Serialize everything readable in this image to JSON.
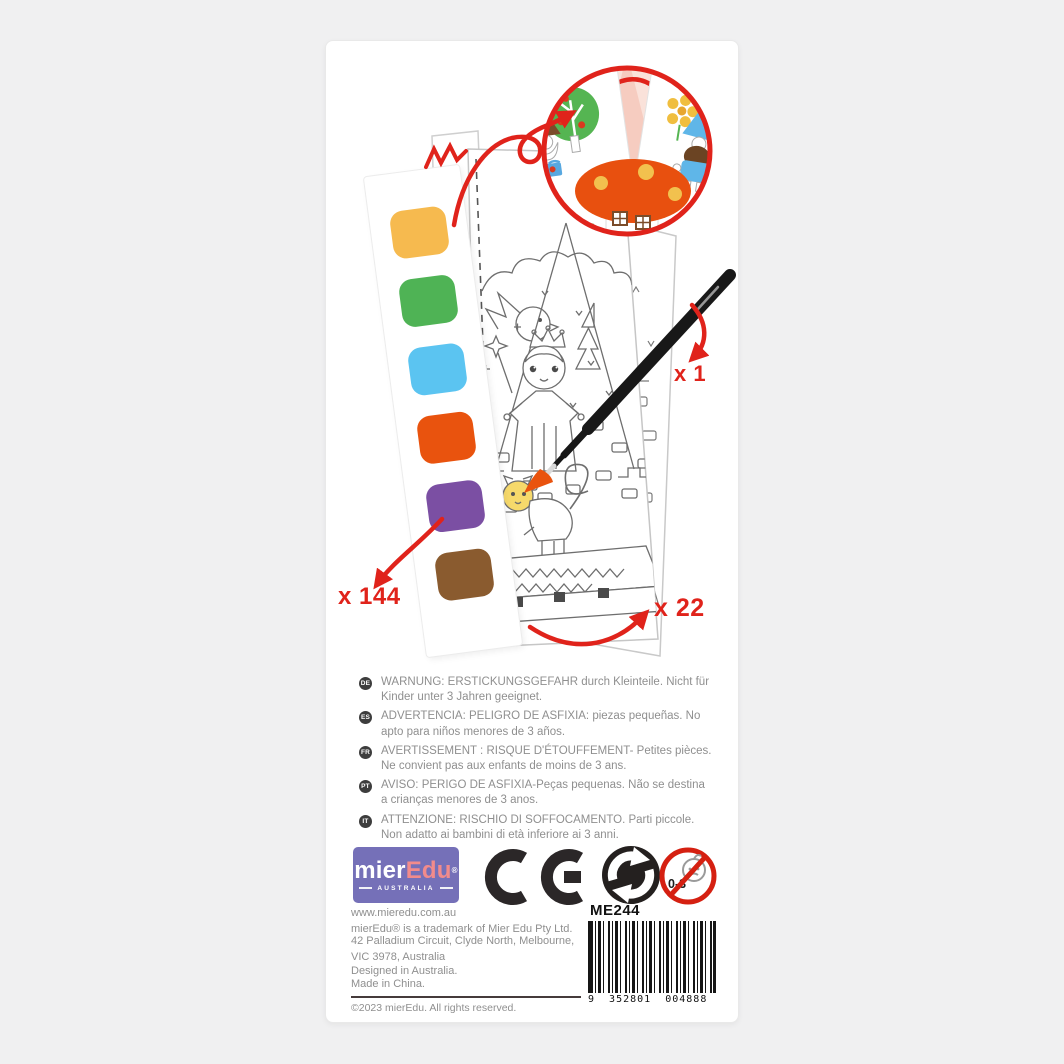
{
  "accent": "#E0231B",
  "photo": {
    "labels": {
      "palette_count": "x 144",
      "brush_count": "x 1",
      "sheet_count": "x 22"
    },
    "palette": {
      "chips": [
        {
          "name": "yellow",
          "hex": "#F6BA4F"
        },
        {
          "name": "green",
          "hex": "#4FB355"
        },
        {
          "name": "blue",
          "hex": "#5BC4F1"
        },
        {
          "name": "orange",
          "hex": "#E9530E"
        },
        {
          "name": "purple",
          "hex": "#7B4FA3"
        },
        {
          "name": "brown",
          "hex": "#8A5B2F"
        }
      ]
    }
  },
  "warnings": [
    {
      "code": "DE",
      "text": "WARNUNG: ERSTICKUNGSGEFAHR durch Kleinteile. Nicht für Kinder unter 3 Jahren geeignet."
    },
    {
      "code": "ES",
      "text": "ADVERTENCIA: PELIGRO DE ASFIXIA: piezas pequeñas. No apto para niños menores de 3 años."
    },
    {
      "code": "FR",
      "text": "AVERTISSEMENT : RISQUE D'ÉTOUFFEMENT- Petites pièces. Ne convient pas aux enfants de moins de 3 ans."
    },
    {
      "code": "PT",
      "text": "AVISO: PERIGO DE ASFIXIA-Peças pequenas. Não se destina a crianças menores de 3 anos."
    },
    {
      "code": "IT",
      "text": "ATTENZIONE: RISCHIO DI SOFFOCAMENTO. Parti piccole. Non adatto ai bambini di età inferiore ai 3 anni."
    }
  ],
  "brand": {
    "name_prefix": "mier",
    "name_suffix": "Edu",
    "registered": "®",
    "country": "AUSTRALIA"
  },
  "badges": {
    "age_warning_label": "0-3"
  },
  "product": {
    "code": "ME244",
    "barcode_digits": "9  352801  004888"
  },
  "footer": {
    "lines": [
      "www.mieredu.com.au",
      "mierEdu® is a trademark of Mier Edu Pty Ltd.",
      "42 Palladium Circuit, Clyde North, Melbourne,",
      "VIC 3978, Australia",
      "Designed in Australia.",
      "Made in China."
    ],
    "copyright": "©2023 mierEdu. All rights reserved."
  }
}
